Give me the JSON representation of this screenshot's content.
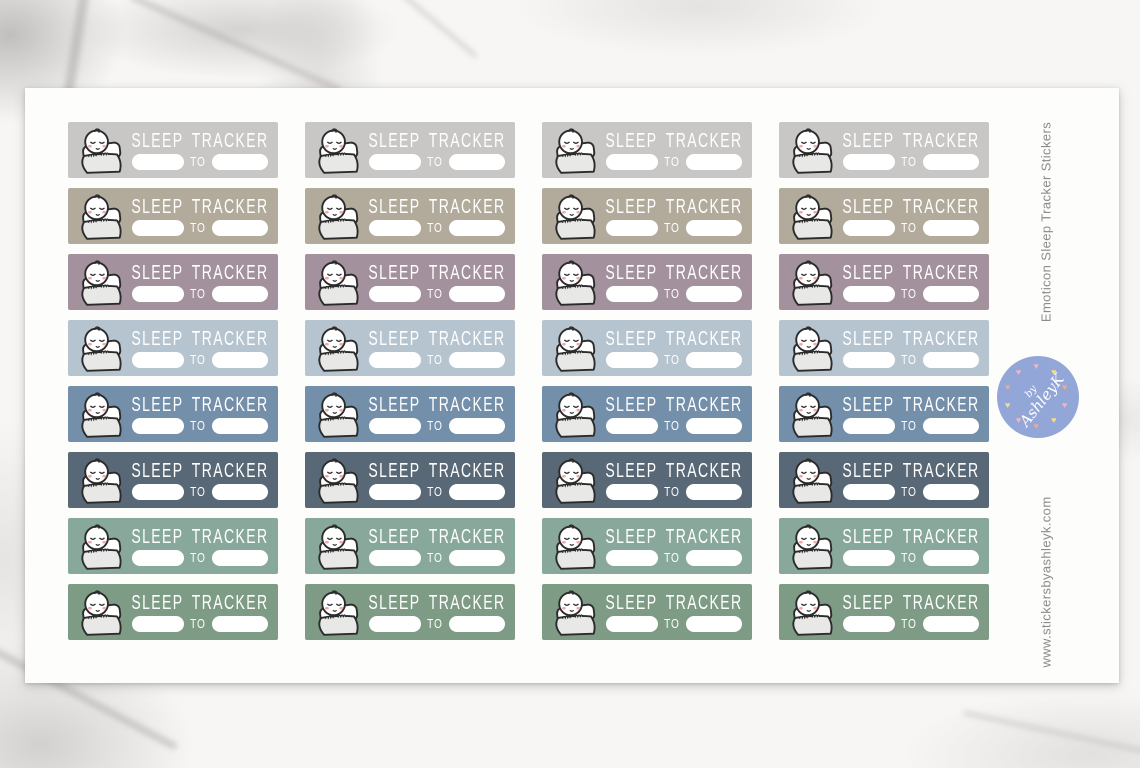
{
  "rail": {
    "product_title_vertical": "Emoticon Sleep Tracker Stickers",
    "website_vertical": "www.stickersbyashleyk.com",
    "text_color": "#8b8b8b"
  },
  "badge": {
    "line1": "by",
    "line2": "AshleyK",
    "bg_color": "#93a6d8",
    "text_color": "#ffffff",
    "heart_colors": [
      "#f5b3bd",
      "#f6dd8d",
      "#f0a98c"
    ],
    "heart_count": 10
  },
  "sticker_sheet": {
    "columns": 4,
    "rows": 8,
    "sticker": {
      "title": "SLEEP TRACKER",
      "connector_label": "TO",
      "icon": "sleeping-emoticon-in-bed-icon",
      "title_color": "#ffffff",
      "blank_color": "#ffffff"
    },
    "row_colors": [
      {
        "name": "light-gray",
        "hex": "#c8c7c5"
      },
      {
        "name": "greige",
        "hex": "#b2ab9b"
      },
      {
        "name": "mauve",
        "hex": "#a3919d"
      },
      {
        "name": "light-blue",
        "hex": "#b5c4cf"
      },
      {
        "name": "slate-blue",
        "hex": "#748fa9"
      },
      {
        "name": "dark-slate",
        "hex": "#596877"
      },
      {
        "name": "sage",
        "hex": "#89a89c"
      },
      {
        "name": "moss-green",
        "hex": "#7e9b86"
      }
    ]
  }
}
